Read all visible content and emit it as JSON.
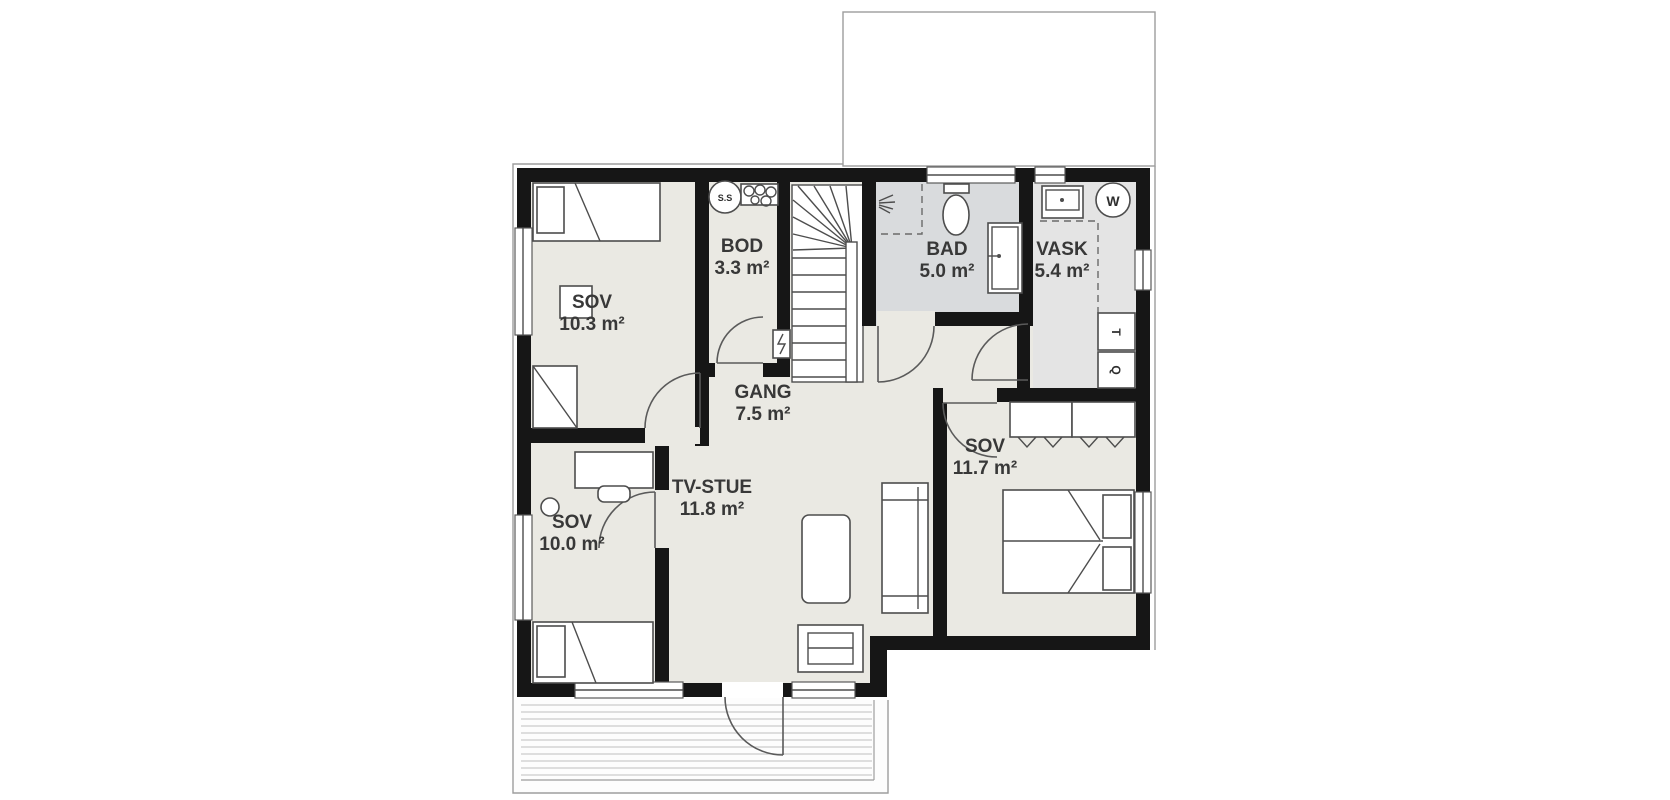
{
  "plan": {
    "rooms": [
      {
        "id": "sov-10-3",
        "name": "SOV",
        "area": "10.3 m²"
      },
      {
        "id": "bod",
        "name": "BOD",
        "area": "3.3 m²"
      },
      {
        "id": "bad",
        "name": "BAD",
        "area": "5.0 m²"
      },
      {
        "id": "vask",
        "name": "VASK",
        "area": "5.4 m²"
      },
      {
        "id": "gang",
        "name": "GANG",
        "area": "7.5 m²"
      },
      {
        "id": "tv-stue",
        "name": "TV-STUE",
        "area": "11.8 m²"
      },
      {
        "id": "sov-10-0",
        "name": "SOV",
        "area": "10.0 m²"
      },
      {
        "id": "sov-11-7",
        "name": "SOV",
        "area": "11.7 m²"
      }
    ],
    "markers": {
      "fusebox": "S.S",
      "water_heater": "W",
      "appliance_t": "T",
      "appliance_q": "Q"
    },
    "colors": {
      "wall": "#161616",
      "floor": "#eae9e3",
      "bathroom_floor": "#d9dbdd",
      "laundry_floor": "#e4e4e4",
      "outline": "#9d9d9d",
      "label": "#383838"
    }
  }
}
